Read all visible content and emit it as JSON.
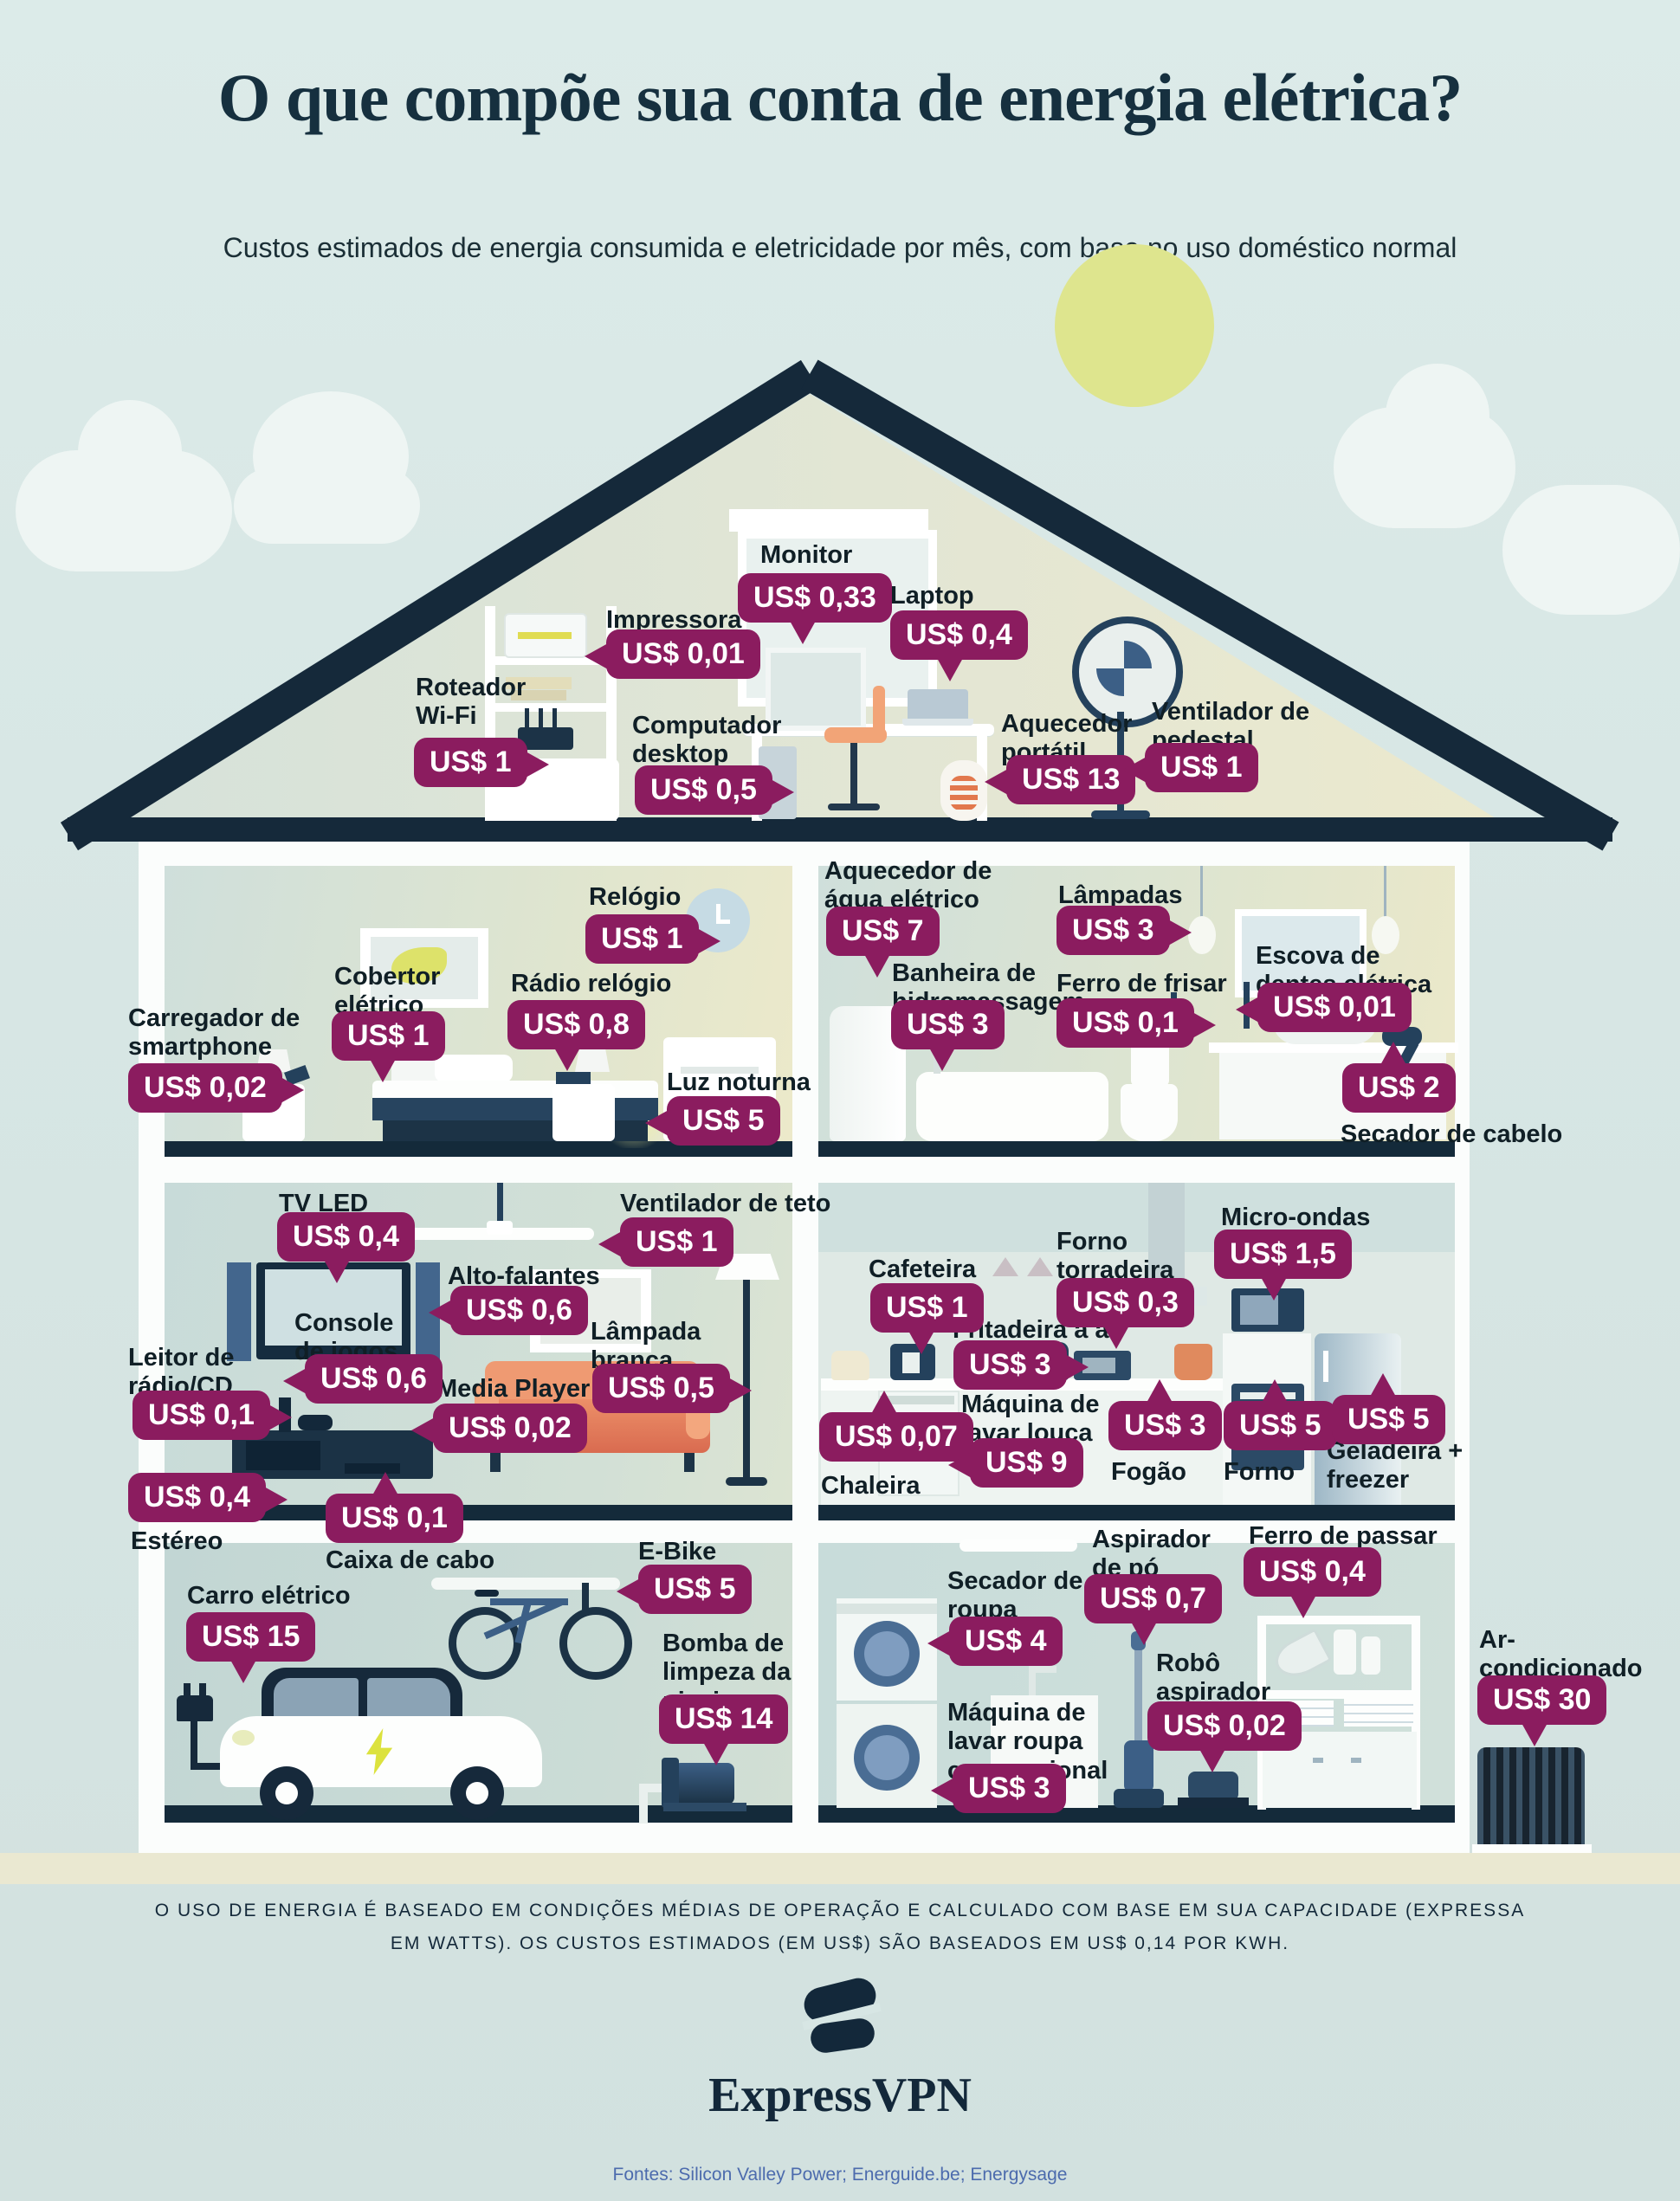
{
  "page": {
    "title": "O que compõe sua conta de energia elétrica?",
    "subtitle": "Custos estimados de energia consumida e eletricidade por mês, com base no uso doméstico normal",
    "footnote": "O uso de energia é baseado em condições médias de operação e calculado com base em sua capacidade (expressa em watts). Os custos estimados (em US$) são baseados em US$ 0,14 por kWh.",
    "brand": "ExpressVPN",
    "sources": "Fontes: Silicon Valley Power; Energuide.be; Energysage"
  },
  "colors": {
    "badge": "#8b1c5f",
    "navy": "#142a3a",
    "sun": "#dee58e",
    "background": "#d9e7e5"
  },
  "rooms": {
    "attic": {
      "items": {
        "monitor": {
          "label": "Monitor",
          "value": "US$ 0,33"
        },
        "impressora": {
          "label": "Impressora",
          "value": "US$ 0,01"
        },
        "laptop": {
          "label": "Laptop",
          "value": "US$ 0,4"
        },
        "roteador": {
          "label": "Roteador\nWi-Fi",
          "value": "US$ 1"
        },
        "computador": {
          "label": "Computador\ndesktop",
          "value": "US$ 0,5"
        },
        "aquecedor_portatil": {
          "label": "Aquecedor\nportátil",
          "value": "US$ 13"
        },
        "ventilador_pedestal": {
          "label": "Ventilador de\npedestal",
          "value": "US$ 1"
        }
      }
    },
    "bedroom": {
      "items": {
        "carregador": {
          "label": "Carregador de\nsmartphone",
          "value": "US$ 0,02"
        },
        "cobertor": {
          "label": "Cobertor\nelétrico",
          "value": "US$ 1"
        },
        "relogio": {
          "label": "Relógio",
          "value": "US$ 1"
        },
        "radio_relogio": {
          "label": "Rádio relógio",
          "value": "US$ 0,8"
        },
        "luz_noturna": {
          "label": "Luz noturna",
          "value": "US$ 5"
        }
      }
    },
    "bathroom": {
      "items": {
        "aquecedor_agua": {
          "label": "Aquecedor de\nágua elétrico",
          "value": "US$ 7"
        },
        "lampadas": {
          "label": "Lâmpadas",
          "value": "US$ 3"
        },
        "banheira": {
          "label": "Banheira de\nhidromassagem",
          "value": "US$ 3"
        },
        "ferro_frisar": {
          "label": "Ferro de frisar",
          "value": "US$ 0,1"
        },
        "escova": {
          "label": "Escova de\ndentes elétrica",
          "value": "US$ 0,01"
        },
        "secador_cabelo": {
          "label": "Secador de cabelo",
          "value": "US$ 2"
        }
      }
    },
    "living": {
      "items": {
        "tv": {
          "label": "TV LED",
          "value": "US$ 0,4"
        },
        "ventilador_teto": {
          "label": "Ventilador de teto",
          "value": "US$ 1"
        },
        "alto_falantes": {
          "label": "Alto-falantes",
          "value": "US$ 0,6"
        },
        "console": {
          "label": "Console\nde jogos",
          "value": "US$ 0,6"
        },
        "leitor": {
          "label": "Leitor de\nrádio/CD",
          "value": "US$ 0,1"
        },
        "media_player": {
          "label": "Media Player",
          "value": "US$ 0,02"
        },
        "lampada_branca": {
          "label": "Lâmpada\nbranca",
          "value": "US$ 0,5"
        },
        "estereo": {
          "label": "Estéreo",
          "value": "US$ 0,4"
        },
        "caixa_cabo": {
          "label": "Caixa de cabo",
          "value": "US$ 0,1"
        }
      }
    },
    "kitchen": {
      "items": {
        "cafeteira": {
          "label": "Cafeteira",
          "value": "US$ 1"
        },
        "forno_torradeira": {
          "label": "Forno\ntorradeira",
          "value": "US$ 0,3"
        },
        "micro_ondas": {
          "label": "Micro-ondas",
          "value": "US$ 1,5"
        },
        "fritadeira": {
          "label": "Fritadeira a ar",
          "value": "US$ 3"
        },
        "chaleira": {
          "label": "Chaleira",
          "value": "US$ 0,07"
        },
        "lava_louca": {
          "label": "Máquina de\nlavar louça",
          "value": "US$ 9"
        },
        "fogao": {
          "label": "Fogão",
          "value": "US$ 3"
        },
        "forno": {
          "label": "Forno",
          "value": "US$ 5"
        },
        "geladeira": {
          "label": "Geladeira +\nfreezer",
          "value": "US$ 5"
        }
      }
    },
    "garage": {
      "items": {
        "carro": {
          "label": "Carro elétrico",
          "value": "US$ 15"
        },
        "ebike": {
          "label": "E-Bike",
          "value": "US$ 5"
        },
        "bomba": {
          "label": "Bomba de\nlimpeza da\npiscina",
          "value": "US$ 14"
        }
      }
    },
    "laundry": {
      "items": {
        "secador_roupa": {
          "label": "Secador de\nroupa",
          "value": "US$ 4"
        },
        "aspirador": {
          "label": "Aspirador\nde pó",
          "value": "US$ 0,7"
        },
        "ferro_passar": {
          "label": "Ferro de passar",
          "value": "US$ 0,4"
        },
        "robo": {
          "label": "Robô\naspirador",
          "value": "US$ 0,02"
        },
        "lava_roupa": {
          "label": "Máquina de\nlavar roupa\nconvencional",
          "value": "US$ 3"
        }
      }
    },
    "outside": {
      "items": {
        "ar_condicionado": {
          "label": "Ar-\ncondicionado",
          "value": "US$ 30"
        }
      }
    }
  }
}
